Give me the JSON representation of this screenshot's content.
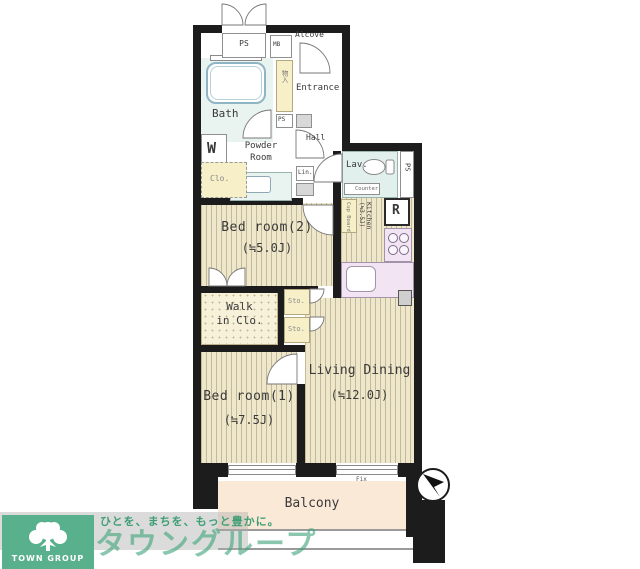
{
  "plan": {
    "type": "apartment-floor-plan",
    "compass": "north-arrow",
    "labels": {
      "ps_top": "PS",
      "mb": "MB",
      "alcove": "Alcove",
      "bath": "Bath",
      "shoes": "物入",
      "ps_entry": "PS",
      "entrance": "Entrance",
      "hall": "Hall",
      "washer": "W",
      "powder_line1": "Powder",
      "powder_line2": "Room",
      "linen": "Lin.",
      "closet": "Clo.",
      "bedroom2_name": "Bed room(2)",
      "bedroom2_size": "(≒5.0J)",
      "lav": "Lav.",
      "lav_counter": "Counter",
      "lav_ps": "PS",
      "cupboard": "Cup Board",
      "kitchen_name": "Kitchen",
      "kitchen_size": "(≒3.5J)",
      "fridge": "R",
      "wic_line1": "Walk",
      "wic_line2": "in Clo.",
      "sto_upper": "Sto.",
      "sto_lower": "Sto.",
      "bedroom1_name": "Bed room(1)",
      "bedroom1_size": "(≒7.5J)",
      "living_name": "Living Dining",
      "living_size": "(≒12.0J)",
      "balcony": "Balcony",
      "fix": "Fix"
    },
    "colors": {
      "wall": "#1c1c1c",
      "tatami_floor": "#efe7cb",
      "kitchen_counter": "#f3e4f4",
      "bath_floor": "#e9f4f1",
      "balcony_floor": "#fbe9d8",
      "storage_yellow": "#f6efc8"
    }
  },
  "logo": {
    "group": "TOWN GROUP",
    "tagline": "ひとを、まちを、もっと豊かに。",
    "brand": "タウングループ",
    "green": "#58b18c"
  }
}
